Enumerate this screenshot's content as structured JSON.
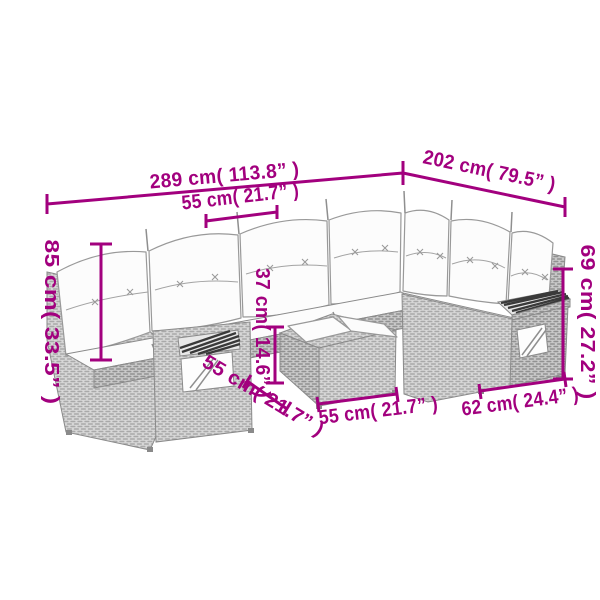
{
  "page": {
    "background": "#ffffff"
  },
  "diagram": {
    "subject": "corner rattan sofa set with ottoman table"
  },
  "annotation": {
    "color": "#a2007e"
  },
  "dimensions": {
    "total_width": "289 cm( 113.8” )",
    "right_depth": "202 cm( 79.5” )",
    "seat_width": "55 cm( 21.7” )",
    "back_height": "85 cm( 33.5” )",
    "table_height": "37 cm( 14.6” )",
    "arm_height": "69 cm( 27.2” )",
    "table_depth": "55 cm( 21.7” )",
    "table_width": "55 cm( 21.7” )",
    "armrest_width": "62 cm( 24.4” )"
  },
  "artwork": {
    "line_color": "#8a8a8a",
    "wicker_fill": "#d7d7d7",
    "wicker_fill_dark": "#c9c9c9",
    "cushion_fill": "#fcfcfc",
    "slat_color": "#3a3a3a"
  }
}
